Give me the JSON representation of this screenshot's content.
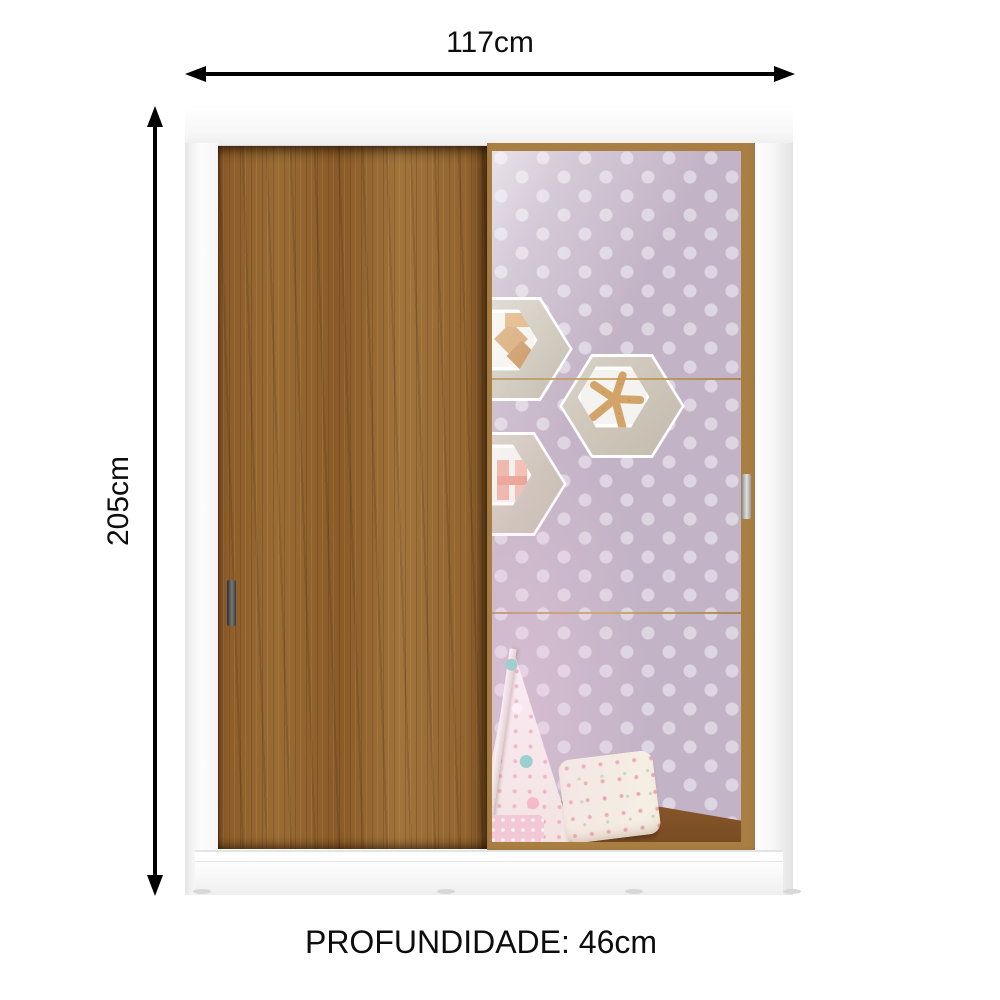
{
  "dimensions": {
    "width_label": "117cm",
    "height_label": "205cm",
    "depth_label": "PROFUNDIDADE: 46cm"
  },
  "icons": {
    "width_arrow": "double-headed-horizontal-arrow",
    "height_arrow": "double-headed-vertical-arrow"
  },
  "colors": {
    "arrow": "#000000",
    "label_text": "#0d0d0d",
    "cabinet_white": "#fbfbfb",
    "cabinet_edge": "#e4e4e4",
    "wood": "#8e6130",
    "wood_dark": "#5f3d18",
    "frame_wood": "#a87e42",
    "mirror_wall": "#c3b3c6",
    "mirror_dot": "#ded5e2",
    "seam": "#b68d50",
    "shelf_outer": "#cdc5b8",
    "shelf_face": "#f5f3ef",
    "starfish": "#d2a469",
    "blocks_wood": "#d6a36c",
    "blocks_pink": "#eeafa0",
    "handle_dark": "#4a4a4a",
    "handle_silver": "#c9c9c9",
    "floor_wood": "#845529",
    "tent_fabric": "#f6f0ea",
    "pillow": "#f4eee3",
    "blanket_pink": "#f2c6d1",
    "pompom_teal": "#74cfc4",
    "pompom_pink": "#f3b3c4"
  }
}
